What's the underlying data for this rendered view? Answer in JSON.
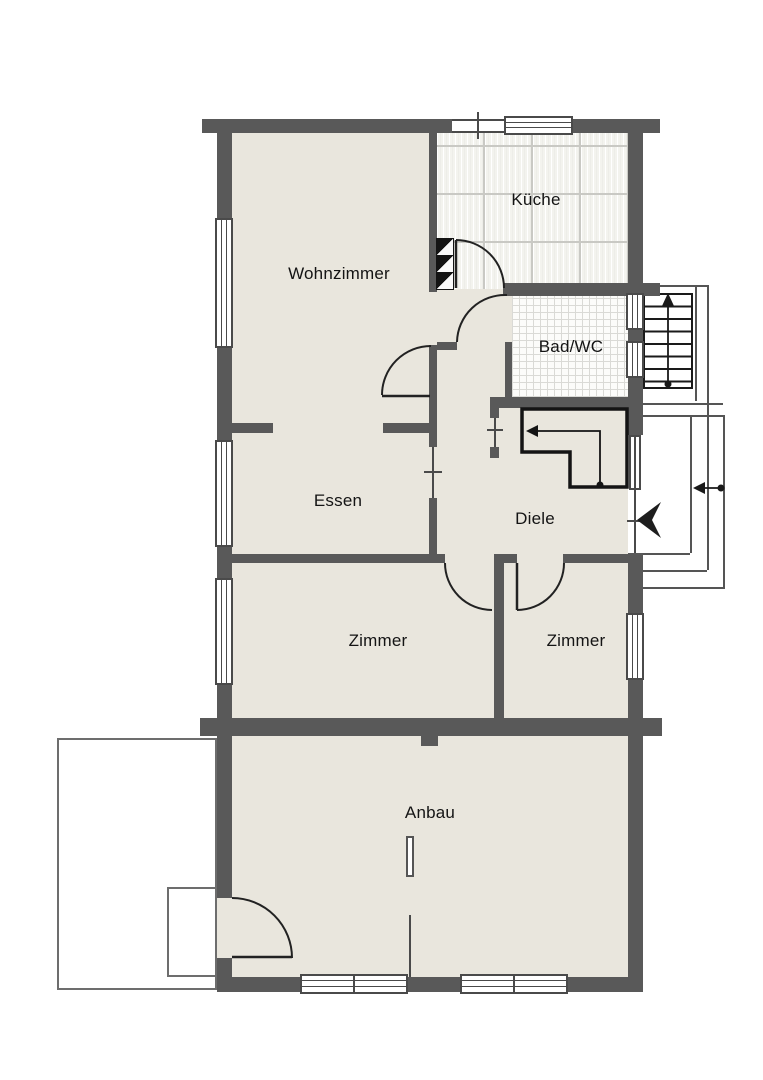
{
  "floorplan": {
    "rooms": {
      "kueche": {
        "label": "Küche"
      },
      "wohnzimmer": {
        "label": "Wohnzimmer"
      },
      "bad": {
        "label": "Bad/WC"
      },
      "essen": {
        "label": "Essen"
      },
      "diele": {
        "label": "Diele"
      },
      "zimmer_left": {
        "label": "Zimmer"
      },
      "zimmer_right": {
        "label": "Zimmer"
      },
      "anbau": {
        "label": "Anbau"
      }
    },
    "colors": {
      "wall": "#595959",
      "floor": "#e9e6dd",
      "kitchen_tile": "#f3f3ee",
      "bath_tile": "#fcfcfa",
      "symbol_black": "#1a1a1a",
      "background": "#ffffff"
    }
  }
}
